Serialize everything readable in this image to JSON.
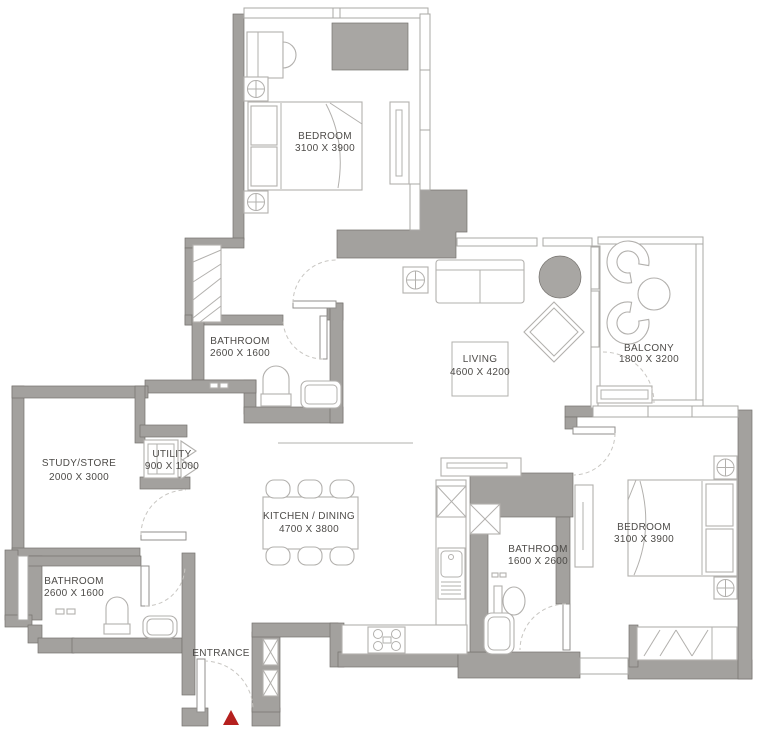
{
  "plan": {
    "type": "apartment-floor-plan",
    "rooms": [
      {
        "id": "bedroom-1",
        "label": "BEDROOM",
        "dims": "3100  X 3900"
      },
      {
        "id": "bathroom-1",
        "label": "BATHROOM",
        "dims": "2600 X 1600"
      },
      {
        "id": "living",
        "label": "LIVING",
        "dims": "4600 X 4200"
      },
      {
        "id": "balcony",
        "label": "BALCONY",
        "dims": "1800 X 3200"
      },
      {
        "id": "study-store",
        "label": "STUDY/STORE",
        "dims": "2000 X 3000"
      },
      {
        "id": "utility",
        "label": "UTILITY",
        "dims": "900 X 1000"
      },
      {
        "id": "kitchen-dining",
        "label": "KITCHEN / DINING",
        "dims": "4700 X 3800"
      },
      {
        "id": "bathroom-2",
        "label": "BATHROOM",
        "dims": "1600 X 2600"
      },
      {
        "id": "bedroom-2",
        "label": "BEDROOM",
        "dims": "3100 X 3900"
      },
      {
        "id": "bathroom-3",
        "label": "BATHROOM",
        "dims": "2600 X 1600"
      }
    ],
    "entrance_label": "ENTRANCE",
    "colors": {
      "wall": "#a3a19e",
      "wall_edge": "#75726e",
      "wall_light": "#a8a6a3",
      "furniture": "#b2b0ad",
      "thin": "#aaa8a5",
      "dash": "#c8c6c2",
      "leaf": "#918f8c",
      "text": "#4d4b48",
      "accent_red": "#b5201e"
    }
  }
}
